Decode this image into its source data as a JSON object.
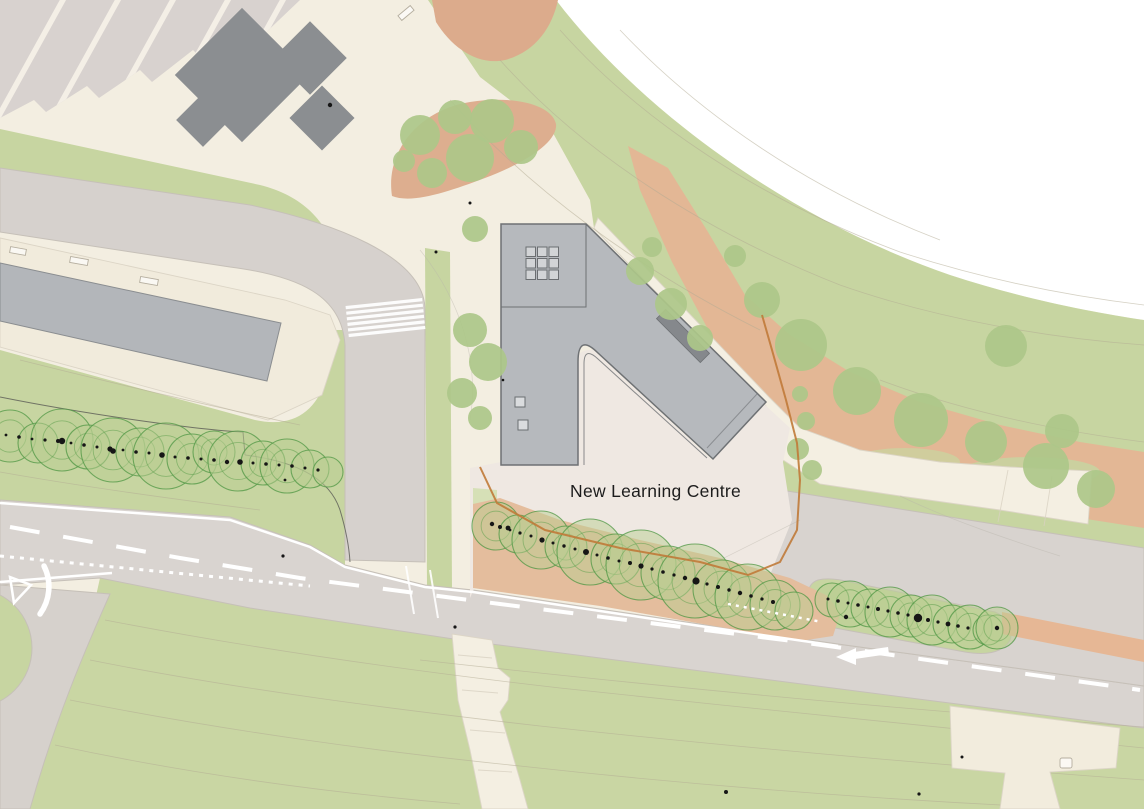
{
  "labels": {
    "building": "New Learning Centre"
  },
  "colors": {
    "out_of_plan": "#ffffff",
    "base": "#f3eee1",
    "grass": "#c7d5a1",
    "grass_light": "#d3dfb2",
    "field": "#c9d6a3",
    "road": "#d9d4d0",
    "road_access": "#d6d1cd",
    "road_upper": "#d8d3cf",
    "parking": "#d8d2cf",
    "apron": "#f1ebdc",
    "path": "#f4efe2",
    "plaza": "#efe8e2",
    "meadow": "#e3b795",
    "meadow_dark": "#ddae8f",
    "planting_bed": "#e4bd9d",
    "salmon_strip": "#e6b795",
    "building": "#b6b9bd",
    "building_outline": "#6e7174",
    "building_existing": "#8b8e91",
    "building_long": "#b3b6ba",
    "rooflight": "#85888c",
    "tree_outline": "#4f9744",
    "tree_fill": "#b9cd92",
    "tree_soft": "#adc789",
    "marking": "#ffffff",
    "boundary": "#c07a38",
    "contour": "#b2ab93",
    "label": "#1c1c1c"
  },
  "trees": {
    "existing_rows": [
      {
        "name": "west-tree-row",
        "circles": [
          [
            10,
            436,
            26
          ],
          [
            38,
            443,
            20
          ],
          [
            62,
            440,
            31
          ],
          [
            88,
            447,
            22
          ],
          [
            113,
            450,
            32
          ],
          [
            140,
            452,
            24
          ],
          [
            166,
            456,
            33
          ],
          [
            192,
            459,
            25
          ],
          [
            214,
            452,
            21
          ],
          [
            238,
            461,
            30
          ],
          [
            263,
            463,
            22
          ],
          [
            287,
            466,
            27
          ],
          [
            310,
            469,
            19
          ],
          [
            328,
            472,
            15
          ]
        ],
        "dots": [
          [
            6,
            435,
            1.4
          ],
          [
            19,
            437,
            1.8
          ],
          [
            32,
            439,
            1.4
          ],
          [
            45,
            440,
            1.6
          ],
          [
            58,
            441,
            2
          ],
          [
            62,
            441,
            3.2
          ],
          [
            71,
            443,
            1.4
          ],
          [
            84,
            445,
            1.8
          ],
          [
            97,
            447,
            1.5
          ],
          [
            110,
            449,
            2.6
          ],
          [
            113,
            451,
            2.8
          ],
          [
            123,
            450,
            1.4
          ],
          [
            136,
            452,
            1.8
          ],
          [
            149,
            453,
            1.5
          ],
          [
            162,
            455,
            2.8
          ],
          [
            175,
            457,
            1.5
          ],
          [
            188,
            458,
            1.8
          ],
          [
            201,
            459,
            1.5
          ],
          [
            214,
            460,
            1.8
          ],
          [
            227,
            462,
            2.2
          ],
          [
            240,
            462,
            2.8
          ],
          [
            253,
            463,
            1.5
          ],
          [
            266,
            464,
            1.8
          ],
          [
            279,
            465,
            1.5
          ],
          [
            292,
            466,
            1.8
          ],
          [
            305,
            468,
            1.5
          ],
          [
            318,
            470,
            1.6
          ]
        ]
      },
      {
        "name": "south-tree-row",
        "circles": [
          [
            496,
            526,
            24
          ],
          [
            518,
            534,
            19
          ],
          [
            541,
            540,
            29
          ],
          [
            566,
            547,
            21
          ],
          [
            590,
            552,
            33
          ],
          [
            616,
            559,
            25
          ],
          [
            641,
            565,
            35
          ],
          [
            668,
            573,
            27
          ],
          [
            695,
            581,
            37
          ],
          [
            722,
            589,
            29
          ],
          [
            748,
            597,
            33
          ],
          [
            775,
            605,
            25
          ],
          [
            794,
            611,
            19
          ]
        ],
        "dots": [
          [
            492,
            524,
            2.2
          ],
          [
            500,
            527,
            2
          ],
          [
            508,
            528,
            2.4
          ],
          [
            510,
            530,
            1.4
          ],
          [
            520,
            533,
            1.6
          ],
          [
            531,
            536,
            1.5
          ],
          [
            542,
            540,
            2.6
          ],
          [
            553,
            543,
            1.5
          ],
          [
            564,
            546,
            1.7
          ],
          [
            575,
            549,
            1.5
          ],
          [
            586,
            552,
            3
          ],
          [
            597,
            555,
            1.5
          ],
          [
            608,
            558,
            1.8
          ],
          [
            619,
            561,
            1.5
          ],
          [
            630,
            563,
            2
          ],
          [
            641,
            566,
            2.6
          ],
          [
            652,
            569,
            1.6
          ],
          [
            663,
            572,
            1.8
          ],
          [
            674,
            575,
            1.6
          ],
          [
            685,
            578,
            2.2
          ],
          [
            696,
            581,
            3.6
          ],
          [
            707,
            584,
            1.6
          ],
          [
            718,
            587,
            2
          ],
          [
            729,
            590,
            1.7
          ],
          [
            740,
            593,
            2.2
          ],
          [
            751,
            596,
            1.8
          ],
          [
            762,
            599,
            1.6
          ],
          [
            773,
            602,
            2
          ]
        ]
      },
      {
        "name": "east-tree-row",
        "circles": [
          [
            832,
            600,
            17
          ],
          [
            850,
            604,
            23
          ],
          [
            870,
            608,
            19
          ],
          [
            890,
            612,
            25
          ],
          [
            911,
            616,
            21
          ],
          [
            932,
            620,
            25
          ],
          [
            952,
            624,
            19
          ],
          [
            970,
            627,
            22
          ],
          [
            988,
            630,
            15
          ],
          [
            997,
            628,
            21
          ]
        ],
        "dots": [
          [
            828,
            599,
            1.5
          ],
          [
            838,
            601,
            1.8
          ],
          [
            848,
            603,
            1.5
          ],
          [
            858,
            605,
            1.8
          ],
          [
            868,
            607,
            1.5
          ],
          [
            878,
            609,
            2
          ],
          [
            888,
            611,
            1.6
          ],
          [
            898,
            613,
            1.8
          ],
          [
            908,
            615,
            1.6
          ],
          [
            918,
            618,
            4.2
          ],
          [
            928,
            620,
            2
          ],
          [
            938,
            622,
            1.6
          ],
          [
            948,
            624,
            2.4
          ],
          [
            958,
            626,
            1.8
          ],
          [
            968,
            628,
            1.6
          ],
          [
            997,
            628,
            2.2
          ]
        ]
      }
    ],
    "proposed": [
      [
        420,
        135,
        20
      ],
      [
        455,
        117,
        17
      ],
      [
        492,
        121,
        22
      ],
      [
        521,
        147,
        17
      ],
      [
        470,
        158,
        24
      ],
      [
        432,
        173,
        15
      ],
      [
        404,
        161,
        11
      ],
      [
        475,
        229,
        13
      ],
      [
        470,
        330,
        17
      ],
      [
        488,
        362,
        19
      ],
      [
        462,
        393,
        15
      ],
      [
        480,
        418,
        12
      ],
      [
        640,
        271,
        14
      ],
      [
        671,
        304,
        16
      ],
      [
        652,
        247,
        10
      ],
      [
        700,
        338,
        13
      ],
      [
        762,
        300,
        18
      ],
      [
        801,
        345,
        26
      ],
      [
        857,
        391,
        24
      ],
      [
        921,
        420,
        27
      ],
      [
        986,
        442,
        21
      ],
      [
        1046,
        466,
        23
      ],
      [
        1096,
        489,
        19
      ],
      [
        1006,
        346,
        21
      ],
      [
        1062,
        431,
        17
      ],
      [
        735,
        256,
        11
      ],
      [
        798,
        449,
        11
      ],
      [
        806,
        421,
        9
      ],
      [
        800,
        394,
        8
      ],
      [
        812,
        470,
        10
      ]
    ],
    "survey_dots": [
      [
        330,
        105,
        2.2
      ],
      [
        283,
        556,
        1.6
      ],
      [
        455,
        627,
        1.6
      ],
      [
        726,
        792,
        2
      ],
      [
        919,
        794,
        1.6
      ],
      [
        846,
        617,
        2.2
      ],
      [
        470,
        203,
        1.5
      ],
      [
        436,
        252,
        1.5
      ],
      [
        962,
        757,
        1.5
      ],
      [
        503,
        380,
        1.3
      ],
      [
        285,
        480,
        1.4
      ]
    ]
  }
}
